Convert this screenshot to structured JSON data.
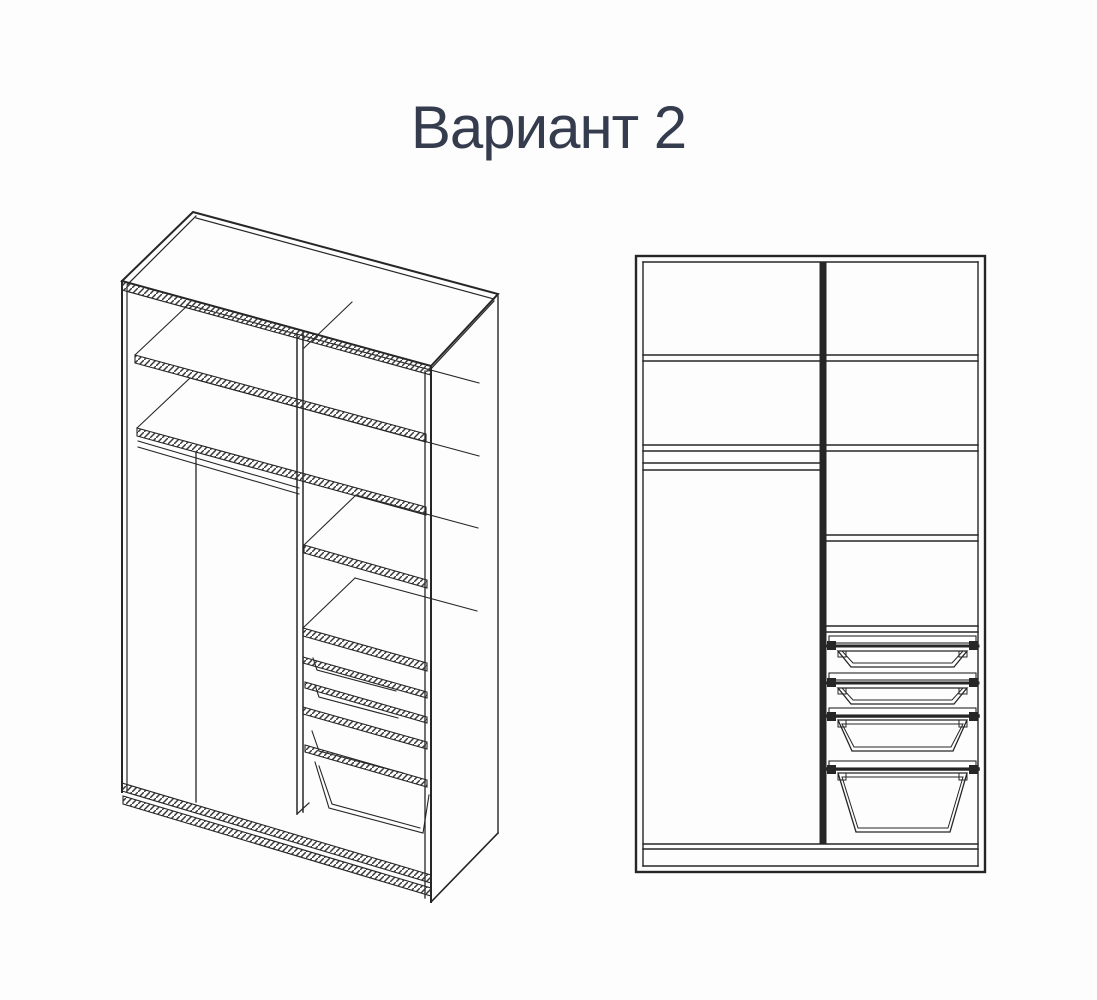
{
  "title": "Вариант 2",
  "colors": {
    "background": "#fdfdfd",
    "line": "#262626",
    "line_soft": "#3a3a3a",
    "title_text": "#353c4e"
  },
  "diagram": {
    "kind": "wardrobe interior configuration drawing",
    "variant_label": "Вариант 2",
    "views": [
      {
        "id": "isometric-view",
        "projection": "isometric cutaway",
        "left_section": [
          "shelf",
          "shelf",
          "hanging rod",
          "open hanging space"
        ],
        "right_section": [
          "shelf",
          "shelf",
          "shelf",
          "shelf",
          "shallow pull-out basket",
          "shallow pull-out basket",
          "deep pull-out basket",
          "deep pull-out basket"
        ],
        "base": "bottom shelf with plinth"
      },
      {
        "id": "front-view",
        "projection": "front elevation",
        "left_section": [
          "shelf",
          "shelf",
          "hanging rod",
          "open hanging space"
        ],
        "right_section": [
          "shelf",
          "shelf",
          "shelf",
          "shelf",
          "shallow pull-out basket",
          "shallow pull-out basket",
          "deep pull-out basket",
          "deep pull-out basket"
        ],
        "base": "bottom shelf with plinth"
      }
    ]
  }
}
